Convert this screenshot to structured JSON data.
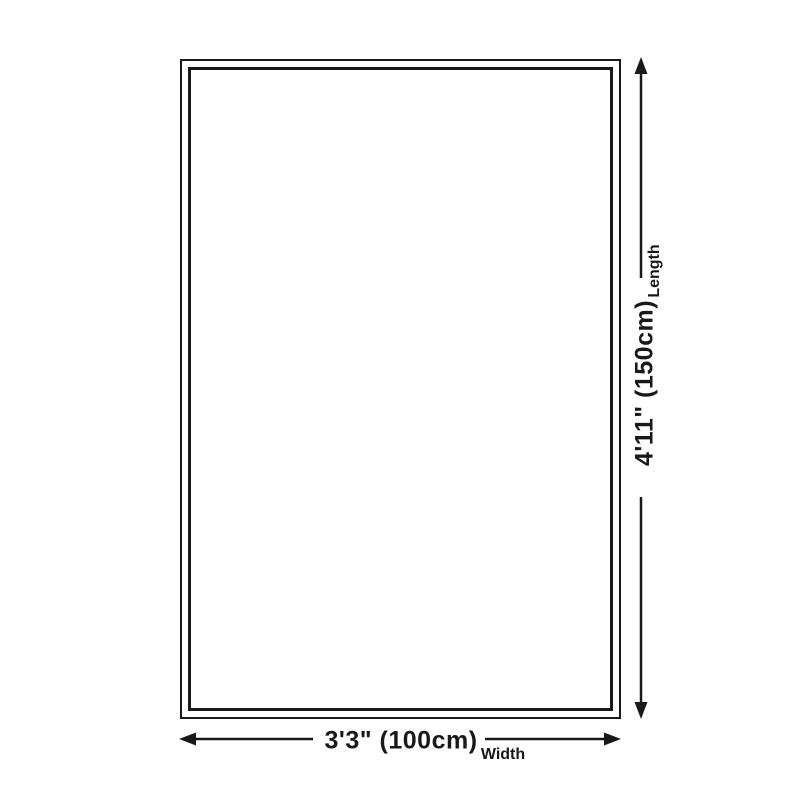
{
  "diagram": {
    "title": "product-size-diagram",
    "length_dimension": {
      "value": "4'11\" (150cm)",
      "label": "Length"
    },
    "width_dimension": {
      "value": "3'3\" (100cm)",
      "label": "Width"
    },
    "colors": {
      "line": "#191919",
      "text": "#191919",
      "background": "#ffffff"
    }
  }
}
